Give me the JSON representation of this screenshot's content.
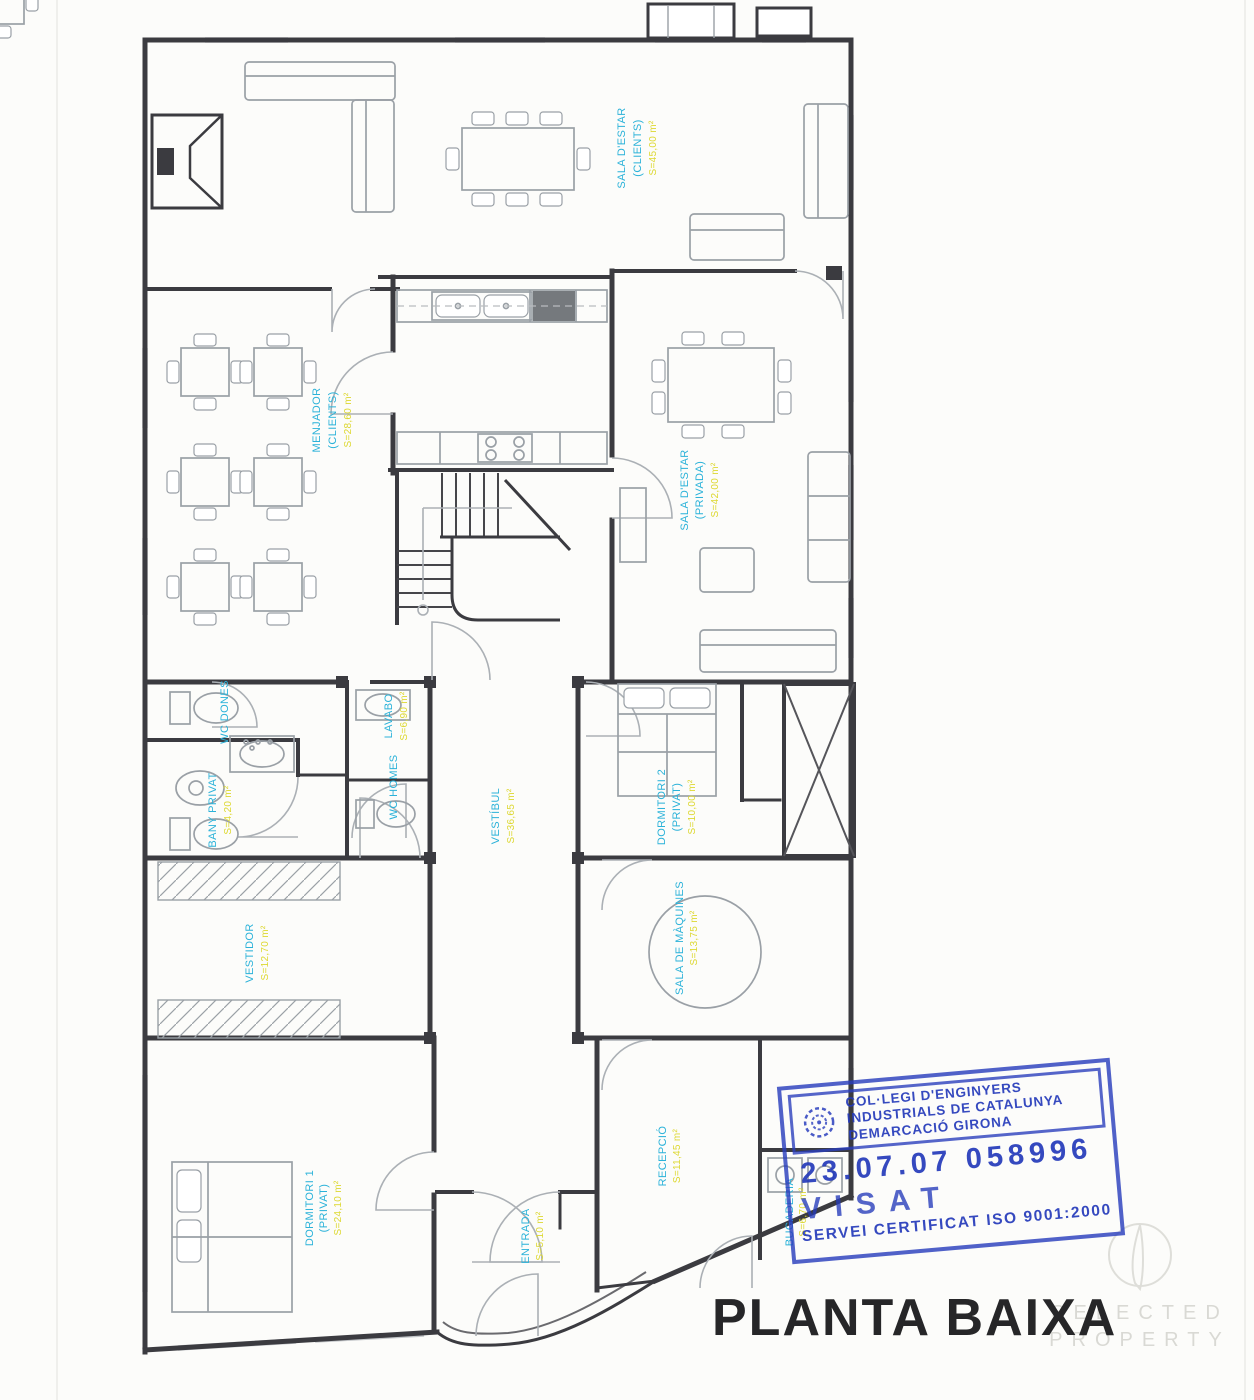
{
  "document": {
    "title_label": "PLANTA BAIXA"
  },
  "rooms": [
    {
      "id": "sala-estar-clients",
      "line1": "SALA D'ESTAR",
      "line2": "(CLIENTS)",
      "area": "S=45,00 m²"
    },
    {
      "id": "menjador-clients",
      "line1": "MENJADOR",
      "line2": "(CLIENTS)",
      "area": "S=28,60 m²"
    },
    {
      "id": "sala-estar-privada",
      "line1": "SALA D'ESTAR",
      "line2": "(PRIVADA)",
      "area": "S=42,00 m²"
    },
    {
      "id": "wc-dones",
      "line1": "WC DONES",
      "line2": "",
      "area": ""
    },
    {
      "id": "lavabo",
      "line1": "LAVABO",
      "line2": "",
      "area": "S=6,90 m²"
    },
    {
      "id": "wc-homes",
      "line1": "WC HOMES",
      "line2": "",
      "area": ""
    },
    {
      "id": "bany-privat",
      "line1": "BANY PRIVAT",
      "line2": "",
      "area": "S=4,20 m²"
    },
    {
      "id": "vestibul",
      "line1": "VESTÍBUL",
      "line2": "",
      "area": "S=36,65 m²"
    },
    {
      "id": "dormitori-2",
      "line1": "DORMITORI 2",
      "line2": "(PRIVAT)",
      "area": "S=10,00 m²"
    },
    {
      "id": "vestidor",
      "line1": "VESTIDOR",
      "line2": "",
      "area": "S=12,70 m²"
    },
    {
      "id": "sala-maquines",
      "line1": "SALA DE MÀQUINES",
      "line2": "",
      "area": "S=13,75 m²"
    },
    {
      "id": "dormitori-1",
      "line1": "DORMITORI 1",
      "line2": "(PRIVAT)",
      "area": "S=24,10 m²"
    },
    {
      "id": "recepcio",
      "line1": "RECEPCIÓ",
      "line2": "",
      "area": "S=11,45 m²"
    },
    {
      "id": "entrada",
      "line1": "ENTRADA",
      "line2": "",
      "area": "S=5,10 m²"
    },
    {
      "id": "bugaderia",
      "line1": "BUGADERIA",
      "line2": "",
      "area": "S=6,70 m²"
    }
  ],
  "stamp": {
    "org_line1": "COL·LEGI D'ENGINYERS",
    "org_line2": "INDUSTRIALS DE CATALUNYA",
    "org_line3": "DEMARCACIÓ GIRONA",
    "number": "23.07.07 058996",
    "status": "VISAT",
    "footer": "SERVEI CERTIFICAT ISO 9001:2000"
  },
  "watermark": {
    "line1": "SELECTED",
    "line2": "PROPERTY"
  },
  "colors": {
    "room_label": "#2bb2d9",
    "area_label": "#ddd832",
    "stamp_blue": "#2a3ebd",
    "wall": "#3b3b40",
    "furniture": "#9aa0a6",
    "watermark": "#d9d9d4"
  }
}
